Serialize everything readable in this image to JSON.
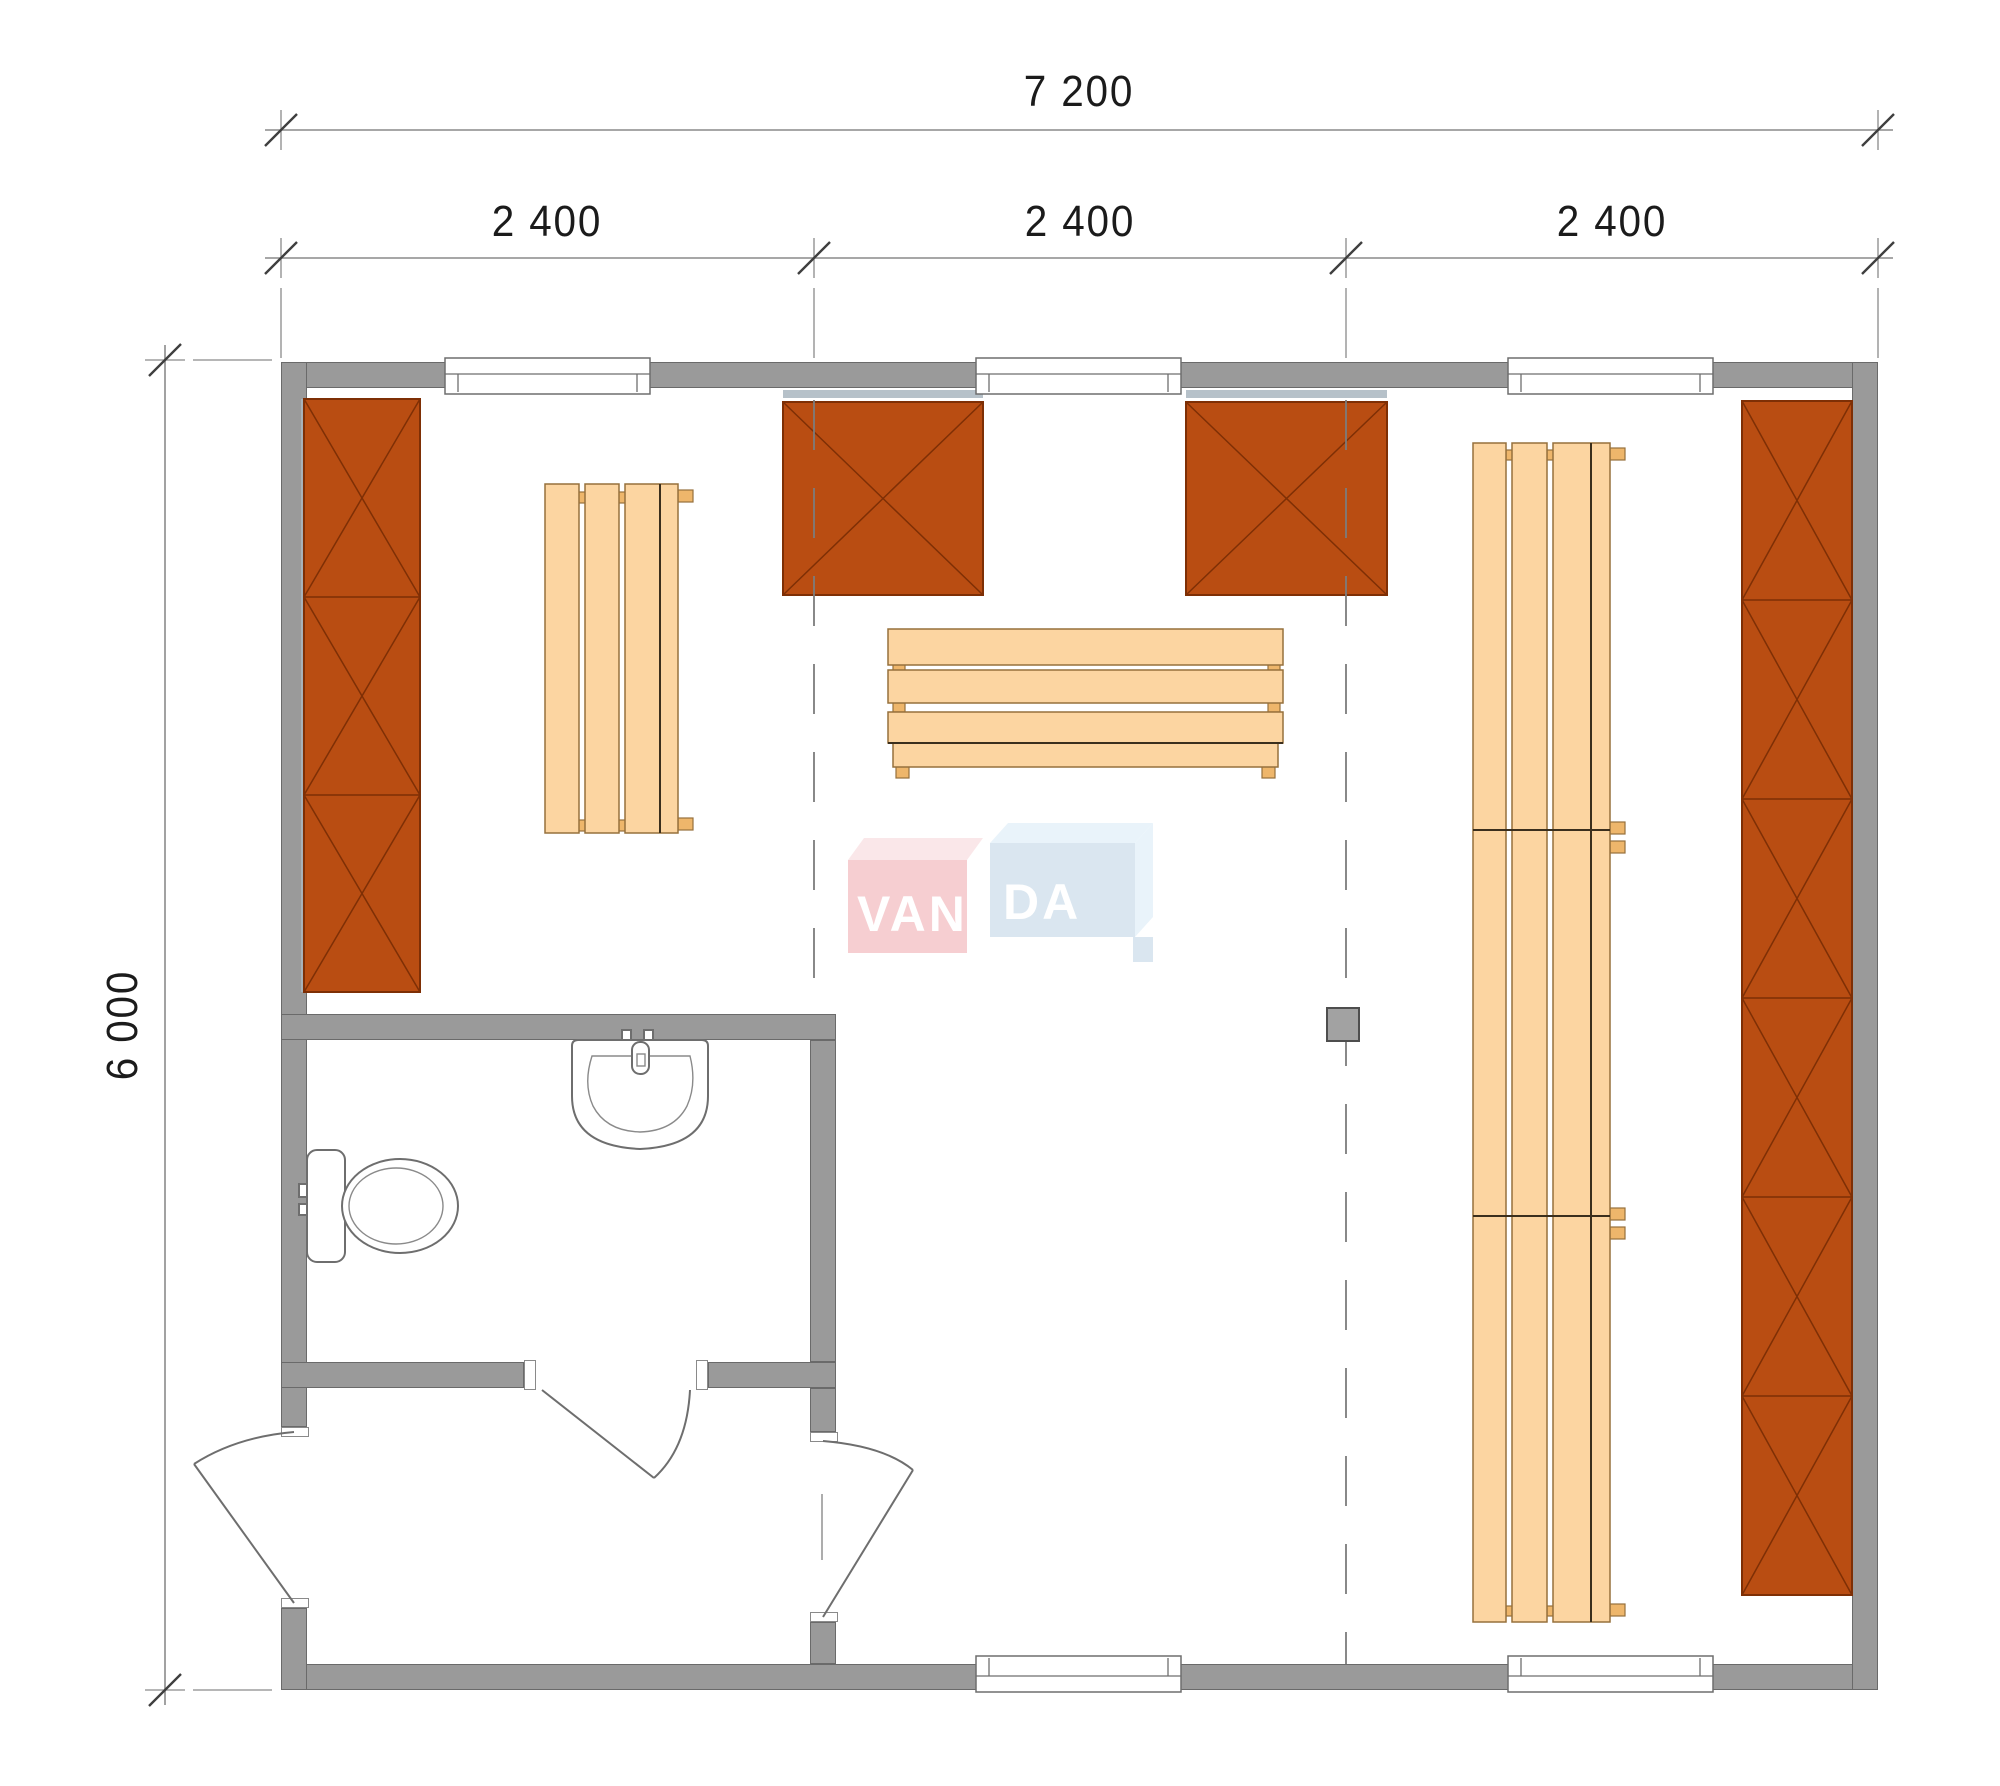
{
  "document": {
    "type": "sauna-cabin-floor-plan",
    "brand": "VANDA"
  },
  "dimensions": {
    "total_width_mm": "7 200",
    "modules_mm": [
      "2 400",
      "2 400",
      "2 400"
    ],
    "total_depth_mm": "6 000"
  },
  "logo": {
    "part1": "VAN",
    "part2": "DA"
  },
  "colors": {
    "wall": "#9a9a9a",
    "wall-border": "#6a6a6a",
    "line": "#8a8a8a",
    "tick": "#3f3f3f",
    "text": "#1b1b1b",
    "unit": "#b94d12",
    "unit-stroke": "#7e2f05",
    "bench": "#fcd5a1",
    "bench-stroke": "#96703c",
    "bench-dark": "#3b2f1d",
    "cleat": "#eeb66b",
    "stove": "#a2a2a2",
    "stove-border": "#4e4e4e",
    "shadow": "#a9b6bf",
    "logo-pink": "#efa3a8",
    "logo-pink-top": "#f7d3d6",
    "logo-blue": "#b9d1e3",
    "logo-blue-top": "#d6e9f6",
    "logo-text": "#ffffff"
  },
  "furniture": [
    {
      "name": "storage-shelf-left"
    },
    {
      "name": "storage-box-top-1"
    },
    {
      "name": "storage-box-top-2"
    },
    {
      "name": "storage-shelf-right"
    },
    {
      "name": "sauna-bench-left"
    },
    {
      "name": "sauna-bench-center"
    },
    {
      "name": "sauna-bench-right"
    },
    {
      "name": "sauna-heater"
    },
    {
      "name": "toilet"
    },
    {
      "name": "washbasin"
    },
    {
      "name": "entry-door"
    },
    {
      "name": "bathroom-door"
    },
    {
      "name": "sauna-room-door"
    },
    {
      "name": "windows"
    }
  ]
}
